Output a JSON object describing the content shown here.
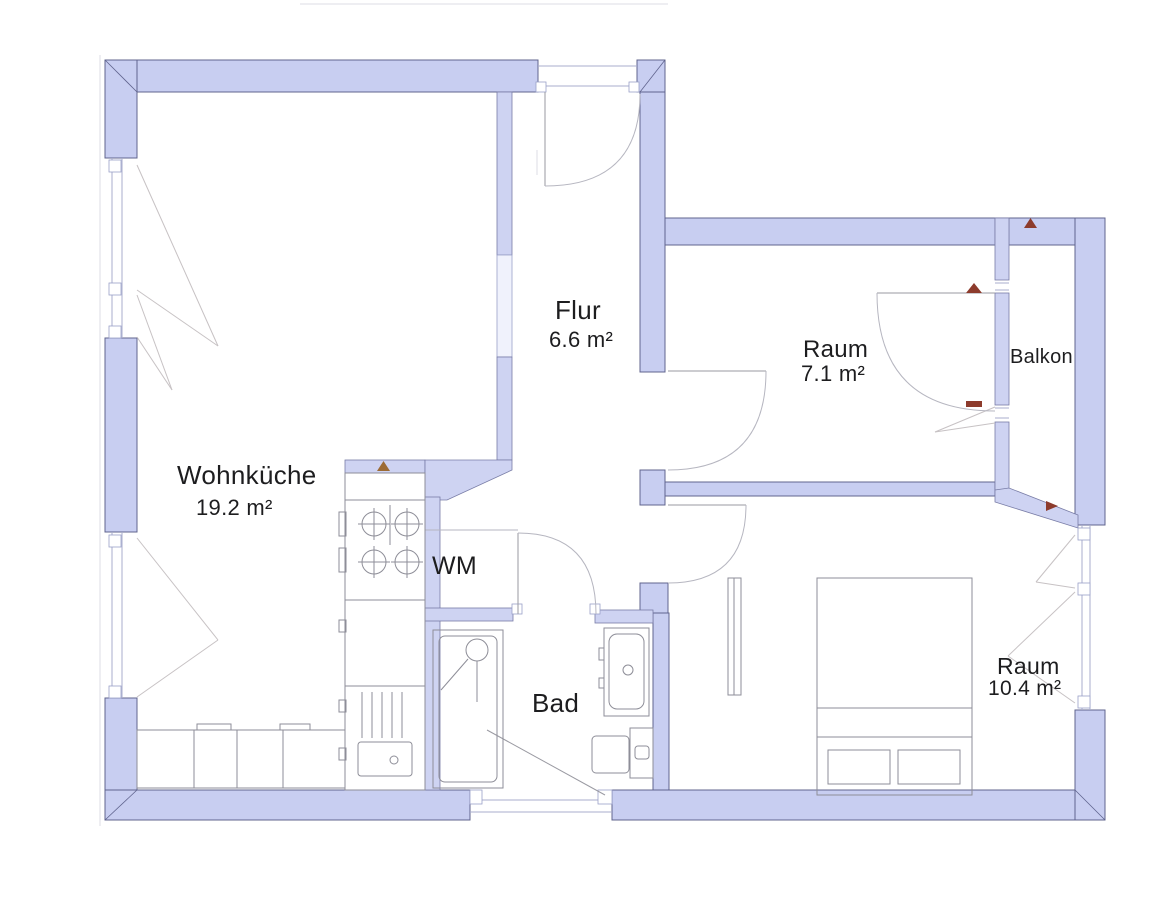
{
  "plan": {
    "rooms": [
      {
        "id": "wohnkueche",
        "name": "Wohnküche",
        "area": "19.2 m²"
      },
      {
        "id": "flur",
        "name": "Flur",
        "area": "6.6 m²"
      },
      {
        "id": "raum-klein",
        "name": "Raum",
        "area": "7.1 m²"
      },
      {
        "id": "balkon",
        "name": "Balkon",
        "area": ""
      },
      {
        "id": "wm",
        "name": "WM",
        "area": ""
      },
      {
        "id": "bad",
        "name": "Bad",
        "area": ""
      },
      {
        "id": "raum-gross",
        "name": "Raum",
        "area": "10.4 m²"
      }
    ],
    "fixtures": [
      "stove-burners",
      "kitchen-unit",
      "kitchen-sink",
      "counter",
      "shower",
      "washbasin",
      "toilet",
      "bed",
      "wardrobe"
    ],
    "colors": {
      "wall_fill": "#c8cef1",
      "wall_outline": "#60648e",
      "fixture_line": "#8e8e98",
      "door_arc": "#b6b6c0",
      "marker_brown": "#9c6b35",
      "marker_red": "#8d3b2c",
      "text": "#1d1d1f",
      "background": "#ffffff"
    }
  }
}
